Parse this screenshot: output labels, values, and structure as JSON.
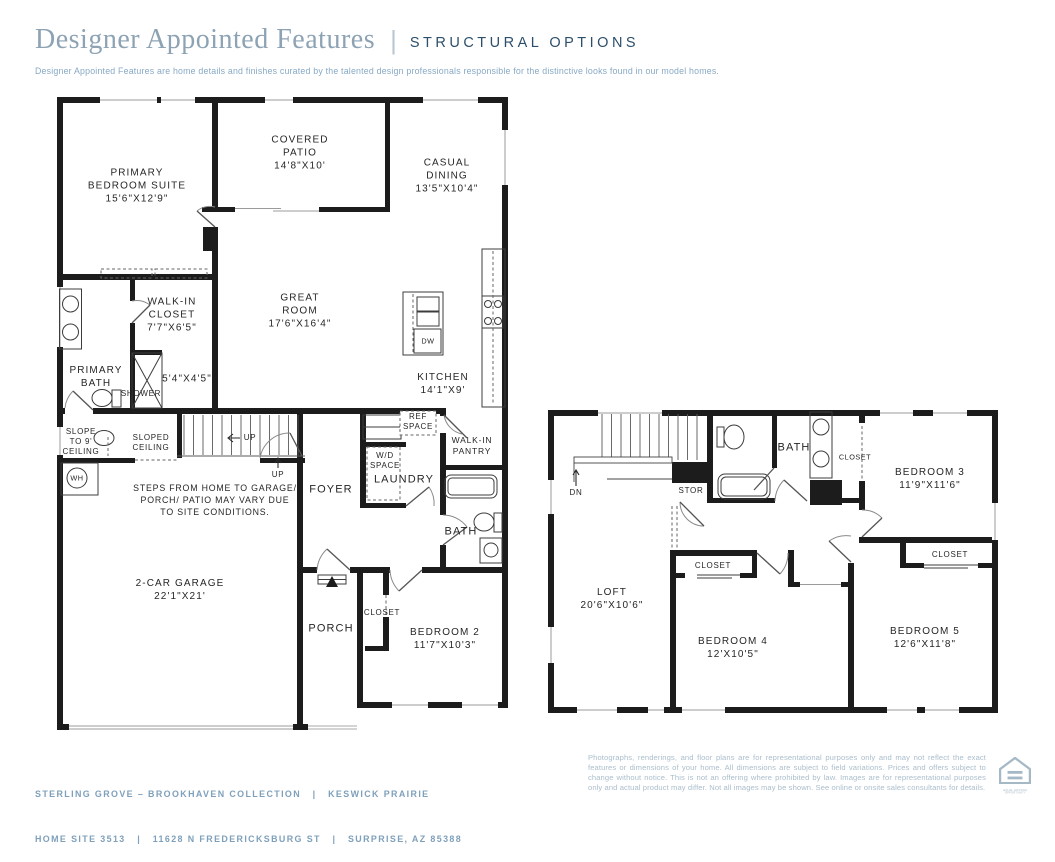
{
  "header": {
    "title": "Designer Appointed Features",
    "divider": "|",
    "tagline": "STRUCTURAL OPTIONS",
    "description": "Designer Appointed Features are home details and finishes curated by the talented design professionals responsible for the distinctive looks found in our model homes."
  },
  "floor1": {
    "primary_bedroom": {
      "l1": "PRIMARY",
      "l2": "BEDROOM SUITE",
      "dims": "15'6\"X12'9\""
    },
    "covered_patio": {
      "l1": "COVERED",
      "l2": "PATIO",
      "dims": "14'8\"X10'"
    },
    "casual_dining": {
      "l1": "CASUAL",
      "l2": "DINING",
      "dims": "13'5\"X10'4\""
    },
    "great_room": {
      "l1": "GREAT",
      "l2": "ROOM",
      "dims": "17'6\"X16'4\""
    },
    "walk_in_closet": {
      "l1": "WALK-IN",
      "l2": "CLOSET",
      "dims": "7'7\"X6'5\""
    },
    "primary_bath": {
      "l1": "PRIMARY",
      "l2": "BATH"
    },
    "shower": {
      "label": "SHOWER",
      "dims": "5'4\"X4'5\""
    },
    "slope_ceiling": {
      "l1": "SLOPE",
      "l2": "TO 9'",
      "l3": "CEILING"
    },
    "sloped_ceiling": {
      "l1": "SLOPED",
      "l2": "CEILING"
    },
    "stairs_up": "UP",
    "entry_up": "UP",
    "water_heater": "WH",
    "steps_note": {
      "l1": "STEPS FROM HOME TO GARAGE/",
      "l2": "PORCH/ PATIO MAY VARY DUE",
      "l3": "TO SITE CONDITIONS."
    },
    "garage": {
      "l1": "2-CAR GARAGE",
      "dims": "22'1\"X21'"
    },
    "foyer": "FOYER",
    "wd_space": {
      "l1": "W/D",
      "l2": "SPACE"
    },
    "laundry": "LAUNDRY",
    "ref_space": {
      "l1": "REF",
      "l2": "SPACE"
    },
    "walk_in_pantry": {
      "l1": "WALK-IN",
      "l2": "PANTRY"
    },
    "kitchen": {
      "l1": "KITCHEN",
      "dims": "14'1\"X9'"
    },
    "dishwasher": "DW",
    "bath": "BATH",
    "porch": "PORCH",
    "closet": "CLOSET",
    "bedroom2": {
      "l1": "BEDROOM 2",
      "dims": "11'7\"X10'3\""
    }
  },
  "floor2": {
    "stairs_dn": "DN",
    "storage": "STOR",
    "bath": "BATH",
    "closet_linen": "CLOSET",
    "bedroom3": {
      "l1": "BEDROOM 3",
      "dims": "11'9\"X11'6\""
    },
    "closet_bedroom5": "CLOSET",
    "closet_bedroom4": "CLOSET",
    "loft": {
      "l1": "LOFT",
      "dims": "20'6\"X10'6\""
    },
    "bedroom4": {
      "l1": "BEDROOM 4",
      "dims": "12'X10'5\""
    },
    "bedroom5": {
      "l1": "BEDROOM 5",
      "dims": "12'6\"X11'8\""
    }
  },
  "footer": {
    "left_line1": "STERLING GROVE – BROOKHAVEN COLLECTION   |   KESWICK PRAIRIE",
    "left_line2": "HOME SITE 3513   |   11628 N FREDERICKSBURG ST   |   SURPRISE, AZ 85388",
    "disclaimer": "Photographs, renderings, and floor plans are for representational purposes only and may not reflect the exact features or dimensions of your home. All dimensions are subject to field variations. Prices and offers subject to change without notice. This is not an offering where prohibited by law. Images are for representational purposes only and actual product may differ. Not all images may be shown. See online or onsite sales consultants for details.",
    "equal_housing_label": "EQUAL HOUSING OPPORTUNITY"
  },
  "colors": {
    "title": "#8da3b4",
    "tagline": "#2c4f6b",
    "subtitle": "#87a9c5",
    "footer_text": "#7fa0bb",
    "disclaimer": "#abbecc",
    "walls": "#1c1c1c"
  }
}
